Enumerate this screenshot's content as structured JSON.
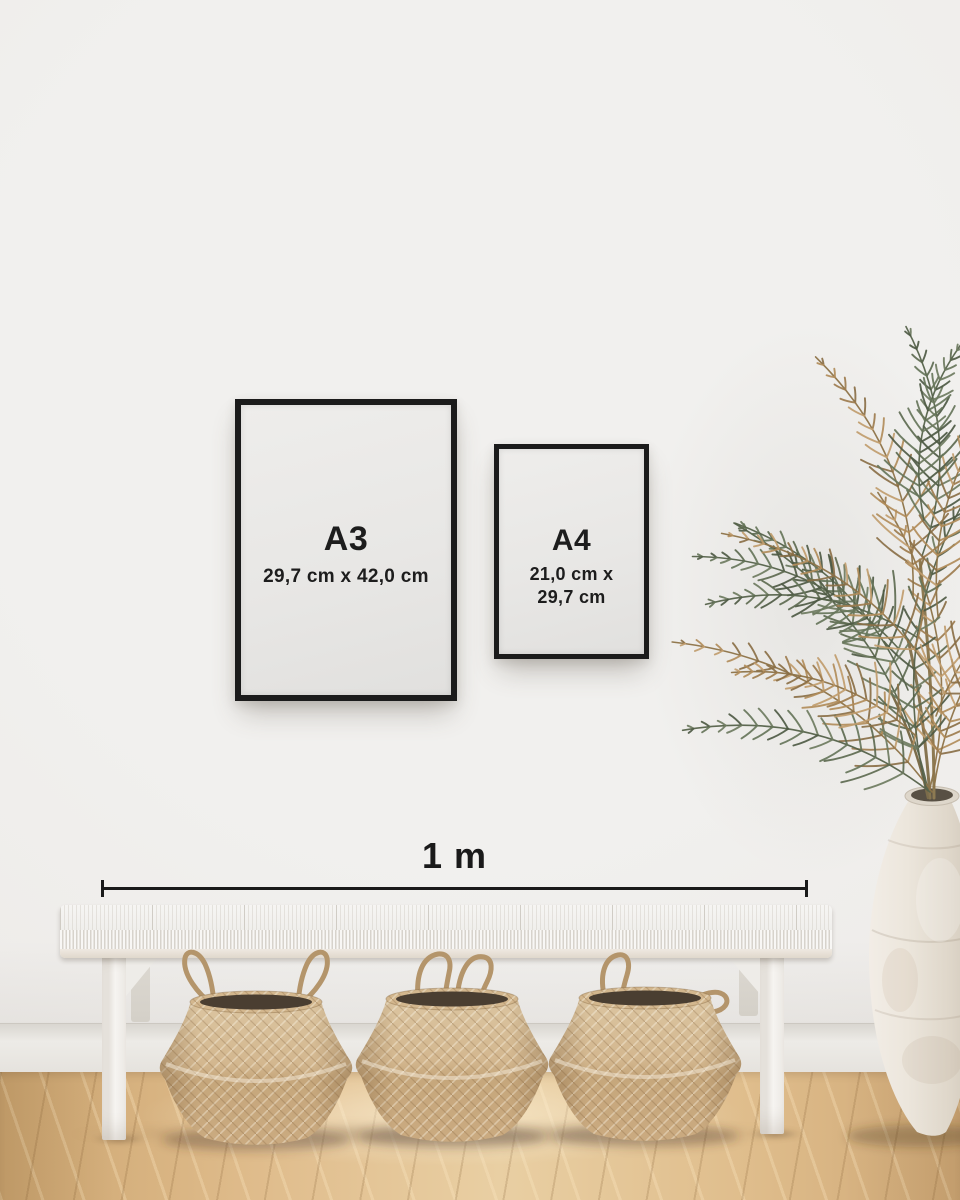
{
  "frames": {
    "a3": {
      "label": "A3",
      "dimensions": "29,7 cm x 42,0 cm"
    },
    "a4": {
      "label": "A4",
      "dimensions_lines": [
        "21,0 cm x",
        "29,7 cm"
      ]
    }
  },
  "scale_bar": {
    "label": "1 m"
  },
  "palette": {
    "wall": "#efedeb",
    "baseboard": "#eae7e2",
    "floor_wood": "#ddbc8e",
    "frame_black": "#1b1b1b",
    "poster_paper": "#e9e8e6",
    "label_text": "#1d1d1d",
    "bench_white": "#f3f2ef",
    "basket_tan": "#cdb088",
    "basket_interior": "#4a3e31",
    "plant_green": "#5d6a50",
    "plant_dried": "#b18c5a",
    "vase_offwhite": "#ebe5db"
  }
}
